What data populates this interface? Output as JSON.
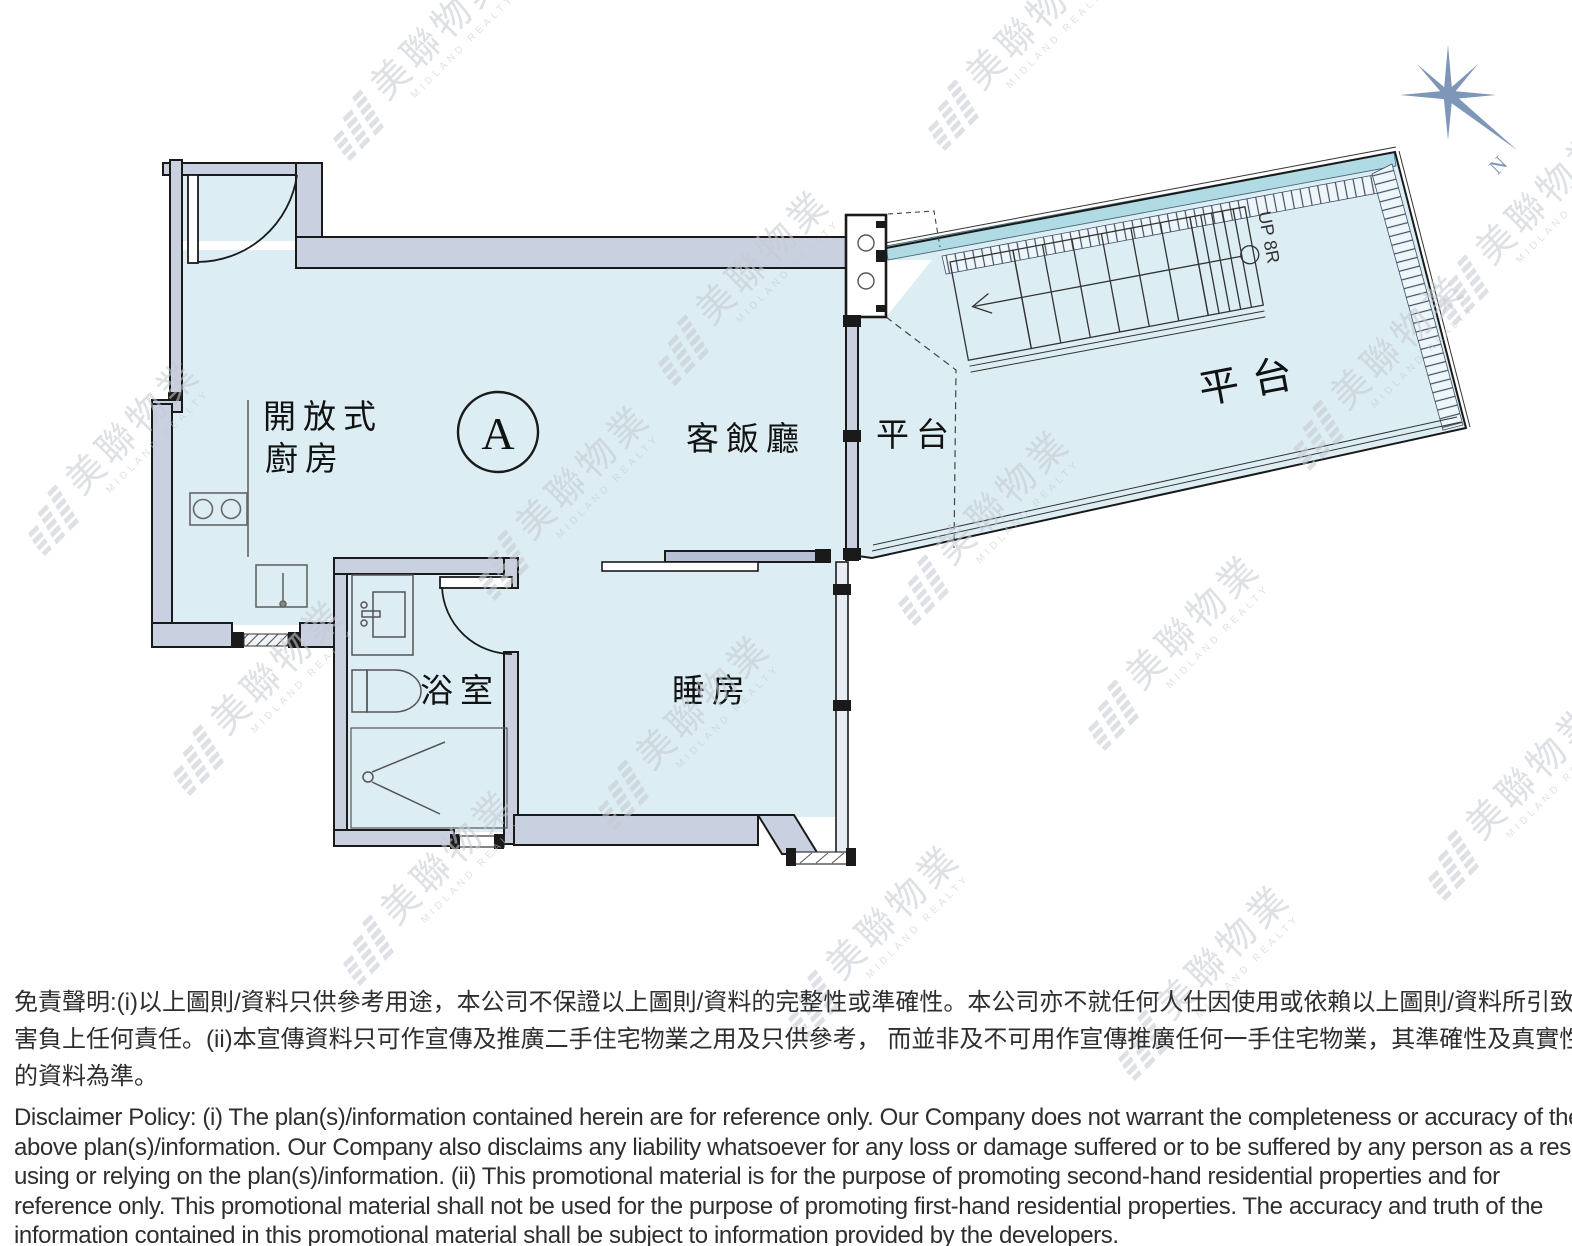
{
  "unit": {
    "label": "A"
  },
  "rooms": {
    "open_kitchen_line1": "開放式",
    "open_kitchen_line2": "廚房",
    "living_dining": "客飯廳",
    "terrace_small": "平台",
    "terrace_large": "平台",
    "bathroom": "浴室",
    "bedroom": "睡房"
  },
  "stairs": {
    "label": "UP 8R"
  },
  "compass": {
    "label": "N"
  },
  "watermark": {
    "cjk": "美聯物業",
    "en": "MIDLAND REALTY",
    "positions": [
      [
        335,
        120
      ],
      [
        30,
        515
      ],
      [
        175,
        755
      ],
      [
        480,
        560
      ],
      [
        345,
        945
      ],
      [
        660,
        345
      ],
      [
        600,
        790
      ],
      [
        790,
        1000
      ],
      [
        930,
        110
      ],
      [
        900,
        585
      ],
      [
        1090,
        710
      ],
      [
        1295,
        430
      ],
      [
        1440,
        285
      ],
      [
        1120,
        1040
      ],
      [
        1430,
        860
      ]
    ]
  },
  "disclaimer": {
    "zh": [
      "免責聲明:(i)以上圖則/資料只供參考用途，本公司不保證以上圖則/資料的完整性或準確性。本公司亦不就任何人仕因使用或依賴以上圖則/資料所引致之任何損失或損",
      "害負上任何責任。(ii)本宣傳資料只可作宣傳及推廣二手住宅物業之用及只供參考， 而並非及不可用作宣傳推廣任何一手住宅物業，其準確性及真實性以樓盤發展商提供",
      "的資料為準。"
    ],
    "en": [
      "Disclaimer Policy: (i) The plan(s)/information contained herein are for reference only. Our Company does not warrant the completeness or accuracy of the",
      "above plan(s)/information. Our Company also disclaims any liability whatsoever for any loss or damage suffered or to be suffered by any person as a result of",
      "using or relying on the plan(s)/information. (ii) This promotional material is for the purpose of promoting second-hand residential properties and for",
      "reference only. This promotional material shall not be used for the purpose of promoting first-hand residential properties. The accuracy and truth of the",
      "information contained in this promotional material shall be subject to information provided by the developers."
    ]
  },
  "colors": {
    "floor": "#dcedf3",
    "wall": "#c9d0df",
    "aqua_ribbon": "#b0dbe5",
    "outline": "#1a1a1a",
    "compass": "#7e96b8",
    "watermark": "#c6cad2"
  }
}
